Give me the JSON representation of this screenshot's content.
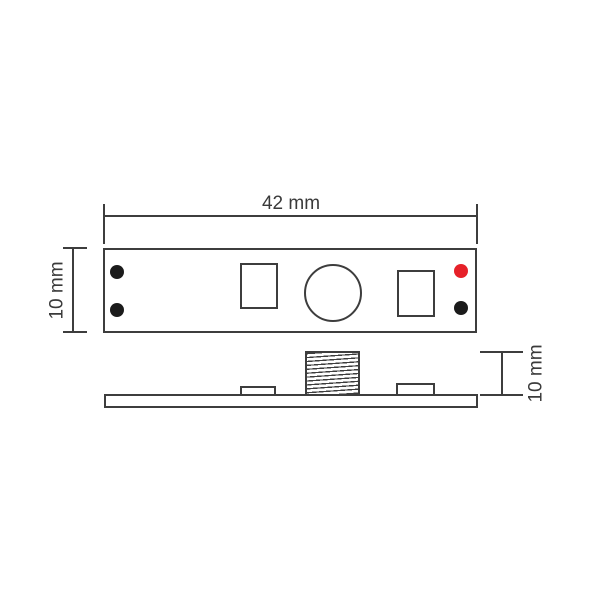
{
  "labels": {
    "board_width": "42 mm",
    "board_height": "10 mm",
    "side_height": "10 mm"
  },
  "colors": {
    "line": "#3d3d3d",
    "dot_black": "#1b1b1b",
    "dot_red": "#e62129"
  }
}
